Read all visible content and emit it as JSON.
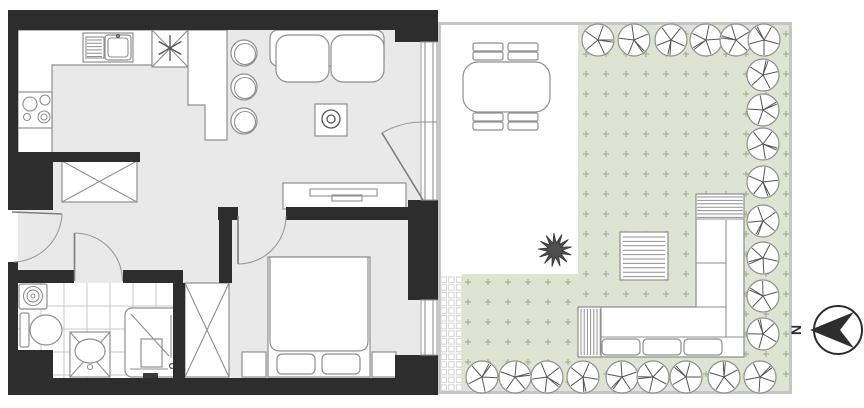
{
  "meta": {
    "type": "apartment floor plan with garden",
    "visible_text": [
      "N"
    ]
  },
  "compass": {
    "label": "N",
    "arrow_points": "left"
  },
  "palette": {
    "wall": "#2d2d2d",
    "floor": "#e9e9e9",
    "outline": "#8f8f8f",
    "detail": "#555555",
    "lawn": "#dde4d1",
    "lawn_mark": "#a6b292",
    "garden_border": "#c6c6c6",
    "tile_line": "#c9c9c9",
    "paver_line": "#d6d6d6"
  },
  "apartment": {
    "rooms": [
      {
        "name": "kitchen-living-room",
        "symbols": [
          "kitchen-counter",
          "sink-with-drainer",
          "refrigerator-snowflake",
          "cooktop-4-burners",
          "bar-counter",
          "bar-stool",
          "bar-stool",
          "bar-stool",
          "two-seat-sofa",
          "coffee-table-with-plant",
          "tv-stand-with-tv",
          "terrace-door"
        ]
      },
      {
        "name": "hallway",
        "symbols": [
          "entrance-door",
          "wardrobe-crossed"
        ]
      },
      {
        "name": "bathroom",
        "symbols": [
          "washing-machine",
          "toilet",
          "vanity-sink-crossed",
          "shower"
        ]
      },
      {
        "name": "bedroom",
        "symbols": [
          "double-bed",
          "pillow",
          "pillow",
          "nightstand",
          "nightstand",
          "wardrobe-crossed",
          "window"
        ]
      }
    ],
    "bath_tiles": {
      "x": 18,
      "y": 283,
      "w": 155,
      "h": 95,
      "step": 23
    }
  },
  "garden": {
    "zones": [
      "terrace",
      "lawn",
      "gravel-strip"
    ],
    "symbols": [
      "dining-table",
      "garden-chair",
      "garden-chair",
      "garden-chair",
      "garden-chair",
      "shrub",
      "striped-garden-table",
      "l-shaped-garden-sofa"
    ],
    "trees": {
      "radius": 16,
      "top_row": {
        "y": 40,
        "x": [
          598,
          634,
          671,
          706,
          736,
          764
        ]
      },
      "right_column": {
        "x": 763,
        "y": [
          75,
          110,
          144,
          182,
          221,
          258,
          296,
          334
        ]
      },
      "bottom_row": {
        "y": 377,
        "x": [
          482,
          515,
          547,
          583,
          622,
          653,
          686,
          724,
          760
        ]
      }
    },
    "lawn_marks": {
      "spacing": 20,
      "size": 6,
      "regions": [
        {
          "x": 586,
          "y": 34,
          "cols": 11,
          "rows": 18
        },
        {
          "x": 468,
          "y": 282,
          "cols": 6,
          "rows": 6
        }
      ]
    },
    "gravel": {
      "x": 441,
      "y": 277,
      "cols": 3,
      "rows": 15,
      "cell": 5.5,
      "pitch": 7.7
    },
    "shrub": {
      "cx": 555,
      "cy": 250,
      "r_outer": 17,
      "r_inner": 7,
      "points": 13
    }
  },
  "stripes": [
    {
      "name": "sink-drainer",
      "x1": 87,
      "y1": 40,
      "x2": 102,
      "count": 6,
      "dy": 3.3
    },
    {
      "name": "garden-table",
      "x1": 623,
      "y1": 237,
      "x2": 665,
      "count": 10,
      "dy": 4.4
    },
    {
      "name": "sofa-cap-top",
      "x1": 697,
      "y1": 197,
      "x2": 743,
      "count": 7,
      "dy": 3.4
    },
    {
      "name": "sofa-cap-left",
      "x1": 581,
      "y1": 309,
      "y2": 355,
      "count": 7,
      "dx": 3.2
    }
  ]
}
